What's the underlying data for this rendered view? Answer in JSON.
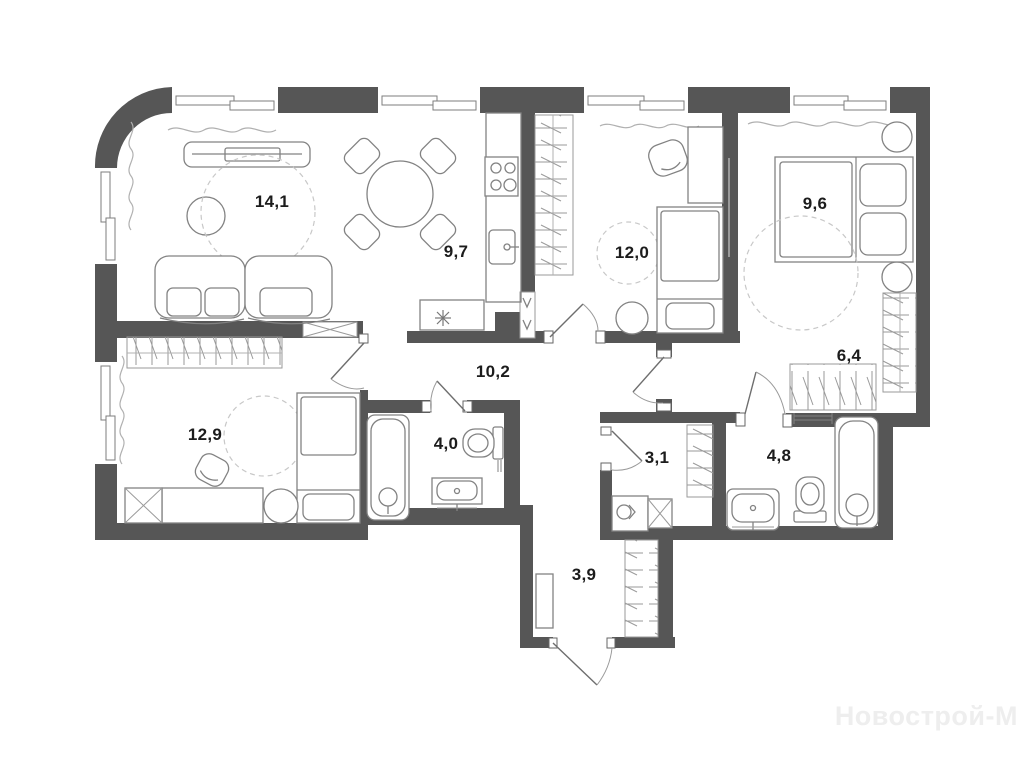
{
  "plan": {
    "type": "apartment-floor-plan",
    "decimal_separator": ",",
    "colors": {
      "wall": "#565656",
      "furniture_line": "#828282",
      "label_text": "#1c1c1c",
      "watermark_text": "#eeeeee",
      "background": "#ffffff"
    }
  },
  "rooms": [
    {
      "name": "living-room",
      "area": "14,1"
    },
    {
      "name": "kitchen-dining",
      "area": "9,7"
    },
    {
      "name": "bedroom-2",
      "area": "12,0"
    },
    {
      "name": "bedroom-3",
      "area": "9,6"
    },
    {
      "name": "wardrobe",
      "area": "6,4"
    },
    {
      "name": "bedroom-1",
      "area": "12,9"
    },
    {
      "name": "hallway",
      "area": "10,2"
    },
    {
      "name": "bathroom-1",
      "area": "4,0"
    },
    {
      "name": "storage",
      "area": "3,1"
    },
    {
      "name": "bathroom-2",
      "area": "4,8"
    },
    {
      "name": "entry-hall",
      "area": "3,9"
    }
  ],
  "watermark": {
    "text": "Новострой-М"
  }
}
